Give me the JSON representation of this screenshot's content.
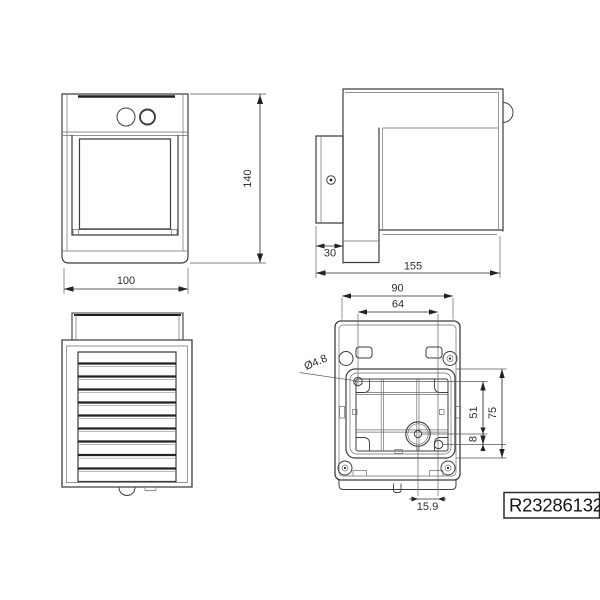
{
  "article_box": {
    "code": "R23286132"
  },
  "front_view": {
    "height": "140",
    "width": "100"
  },
  "side_view": {
    "plate_depth": "30",
    "total_depth": "155"
  },
  "back_view": {
    "mount_width": "90",
    "hole_spacing": "64",
    "hole_diameter": "Ø4.8",
    "hole_to_cable_vertical": "51",
    "recess_height": "75",
    "cable_vertical_offset": "8",
    "cable_horizontal_offset": "15.9"
  }
}
